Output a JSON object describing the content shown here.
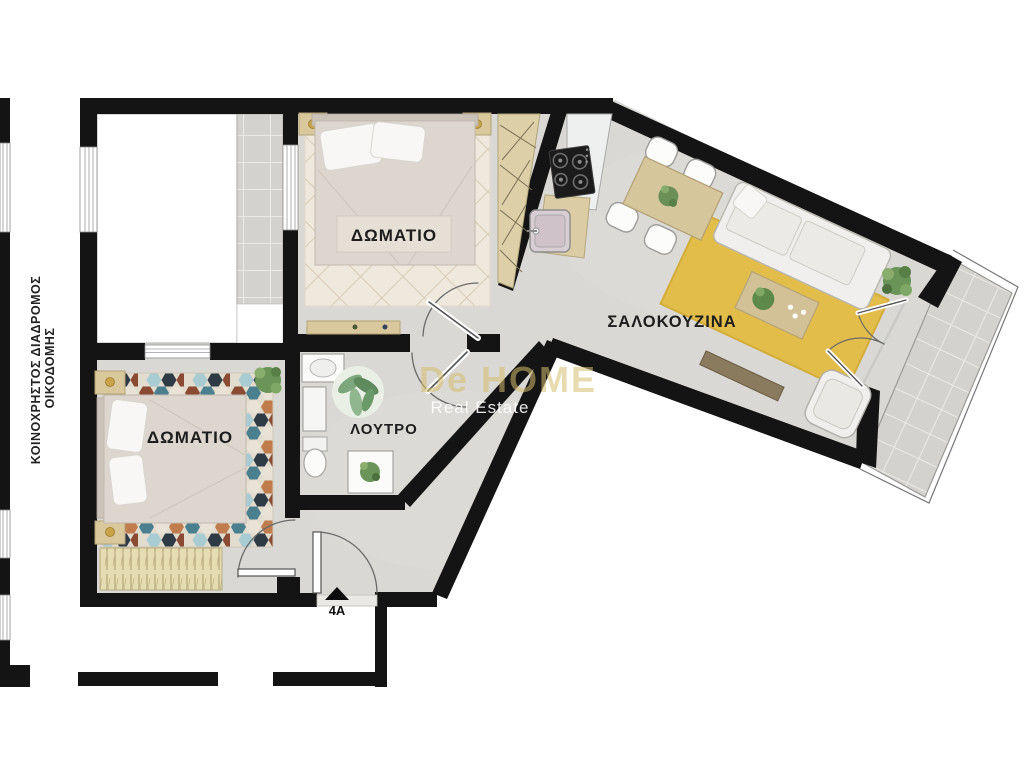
{
  "title": "Apartment 4A floor plan",
  "labels": {
    "bedroom1": "ΔΩΜΑΤΙΟ",
    "bedroom2": "ΔΩΜΑΤΙΟ",
    "bathroom": "ΛΟΥΤΡΟ",
    "living_kitchen": "ΣΑΛΟΚΟΥΖΙΝΑ",
    "corridor_line1": "ΚΟΙΝΟΧΡΗΣΤΟΣ ΔΙΑΔΡΟΜΟΣ",
    "corridor_line2": "ΟΙΚΟΔΟΜΗΣ",
    "entrance_unit": "4A"
  },
  "watermark": {
    "line1": "De HOME",
    "line2": "Real Estate"
  },
  "colors": {
    "wall": "#141414",
    "floor": "#d9d8d4",
    "balcony_tile": "#d3d2ce",
    "rug_yellow": "#e3bd4a",
    "wood": "#d8c9a0",
    "rug_cream": "#efe9dd",
    "watermark": "#d5be6e"
  }
}
